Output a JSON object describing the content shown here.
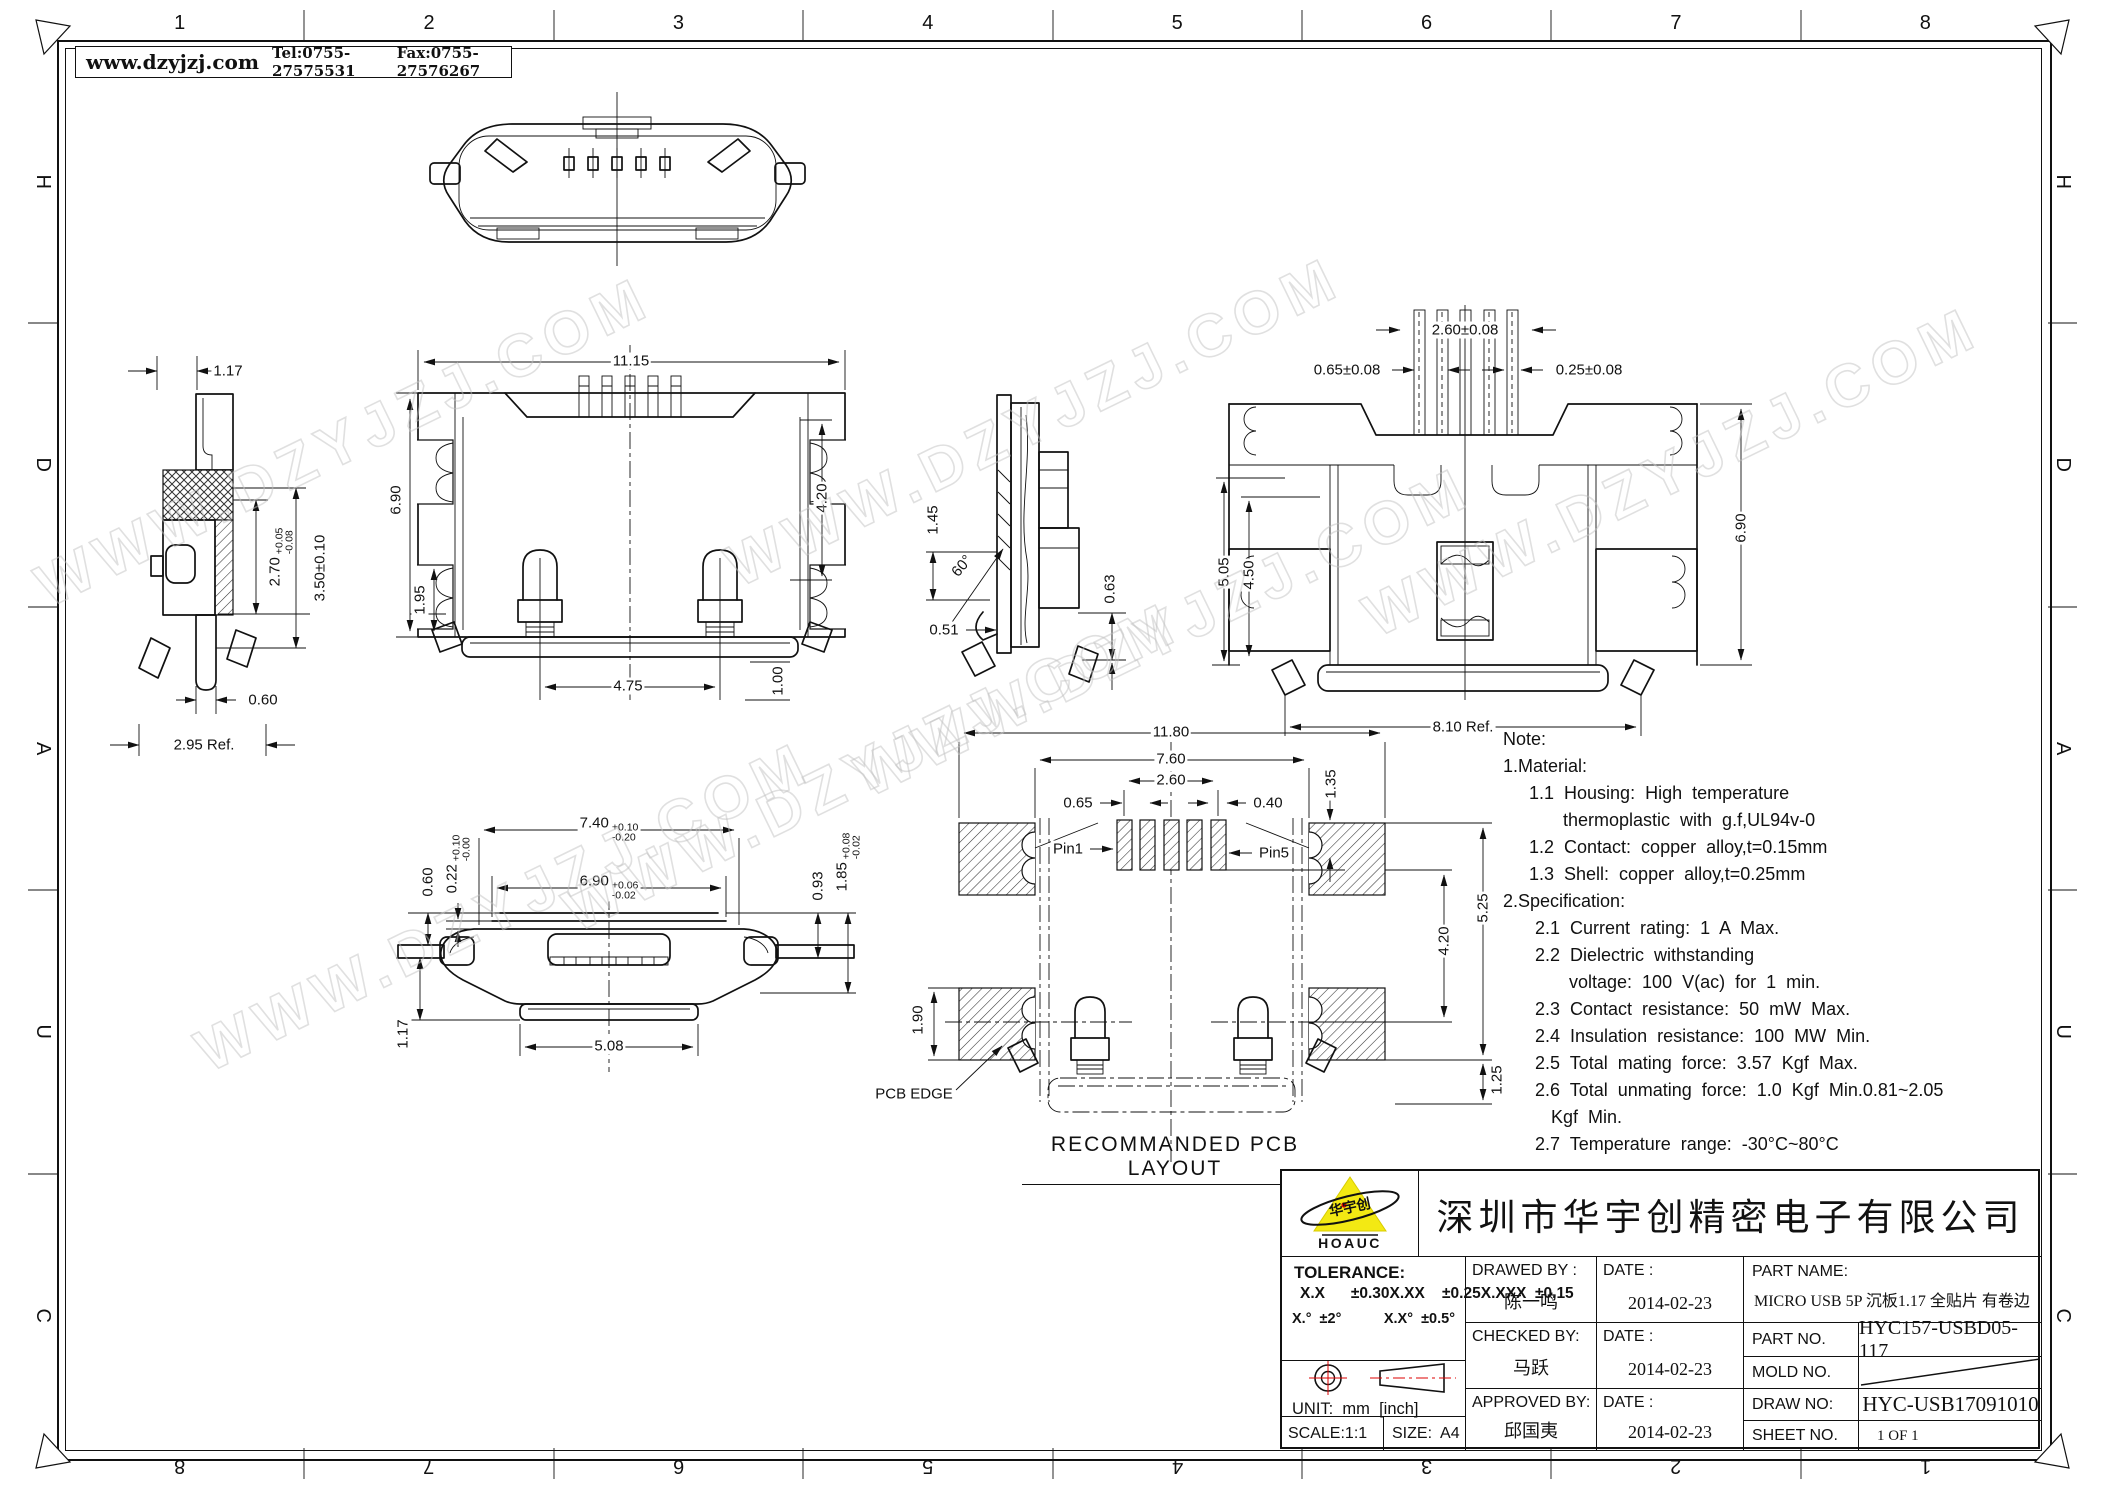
{
  "header": {
    "website": "www.dzyjzj.com",
    "tel": "Tel:0755-27575531",
    "fax": "Fax:0755-27576267"
  },
  "frame": {
    "cols_top": [
      "1",
      "2",
      "3",
      "4",
      "5",
      "6",
      "7",
      "8"
    ],
    "cols_bottom": [
      "8",
      "7",
      "6",
      "5",
      "4",
      "3",
      "2",
      "1"
    ],
    "rows_left": [
      "H",
      "D",
      "A",
      "U",
      "C"
    ],
    "rows_right": [
      "H",
      "D",
      "A",
      "U",
      "C"
    ]
  },
  "watermark": {
    "text": "WWW.DZYJZJ.COM"
  },
  "views": {
    "side": {
      "w": "1.17",
      "h1": "2.70",
      "h1up": "+0.05",
      "h1dn": "-0.08",
      "h2": "3.50±0.10",
      "pin": "0.60",
      "ref": "2.95 Ref."
    },
    "front": {
      "w": "11.15",
      "h": "6.90",
      "h2": "1.95",
      "r": "4.20",
      "b": "4.75",
      "b2": "1.00"
    },
    "section": {
      "a": "1.45",
      "ang": "60°",
      "b": "0.51",
      "c": "0.63"
    },
    "back": {
      "t": "2.60±0.08",
      "tl": "0.65±0.08",
      "tr": "0.25±0.08",
      "l1": "5.05",
      "l2": "4.50",
      "r": "6.90",
      "b": "8.10 Ref."
    },
    "bottom": {
      "d1": "7.40",
      "d1up": "+0.10",
      "d1dn": "-0.20",
      "d2": "6.90",
      "d2up": "+0.06",
      "d2dn": "-0.02",
      "d3": "0.60",
      "d4": "0.22",
      "d4up": "+0.10",
      "d4dn": "-0.00",
      "d5": "0.93",
      "d6": "1.85",
      "d6up": "+0.08",
      "d6dn": "-0.02",
      "d7": "1.17",
      "d8": "5.08"
    },
    "pcb": {
      "d1": "11.80",
      "d2": "7.60",
      "d3": "2.60",
      "d4": "0.65",
      "d5": "0.40",
      "d6": "1.35",
      "pin1": "Pin1",
      "pin5": "Pin5",
      "d7": "4.20",
      "d8": "5.25",
      "d9": "1.90",
      "d10": "1.25",
      "edge": "PCB EDGE",
      "caption": "RECOMMANDED PCB LAYOUT"
    }
  },
  "notes": {
    "lines": [
      "Note:",
      "1.Material:",
      "1.1 Housing: High temperature",
      "thermoplastic with g.f,UL94v-0",
      "1.2 Contact: copper alloy,t=0.15mm",
      "1.3 Shell: copper alloy,t=0.25mm",
      "2.Specification:",
      "2.1 Current rating: 1 A Max.",
      "2.2 Dielectric withstanding",
      "voltage: 100 V(ac) for 1 min.",
      "2.3 Contact resistance: 50 mW Max.",
      "2.4 Insulation resistance: 100 MW Min.",
      "2.5 Total mating force: 3.57 Kgf Max.",
      "2.6 Total unmating force: 1.0 Kgf Min.0.81~2.05",
      "Kgf Min.",
      "2.7 Temperature range: -30°C~80°C"
    ]
  },
  "title_block": {
    "company": "深圳市华宇创精密电子有限公司",
    "logo": {
      "cn": "华宇创",
      "en": "HOAUC"
    },
    "tolerance": {
      "label": "TOLERANCE:",
      "rows": [
        "X.X      ±0.30",
        "X.XX    ±0.25",
        "X.XXX  ±0.15"
      ],
      "angle1": "X.°  ±2°",
      "angle2": "X.X°  ±0.5°"
    },
    "unit": "UNIT:  mm  [inch]",
    "scale": "SCALE:1:1",
    "size": "SIZE:  A4",
    "drawed": {
      "label": "DRAWED BY :",
      "name": "陈一鸣",
      "date_label": "DATE :",
      "date": "2014-02-23"
    },
    "checked": {
      "label": "CHECKED BY:",
      "name": "马跃",
      "date_label": "DATE :",
      "date": "2014-02-23"
    },
    "approved": {
      "label": "APPROVED BY:",
      "name": "邱国夷",
      "date_label": "DATE :",
      "date": "2014-02-23"
    },
    "part_name": {
      "label": "PART NAME:",
      "value": "MICRO USB 5P 沉板1.17 全贴片 有卷边"
    },
    "part_no": {
      "label": "PART NO.",
      "value": "HYC157-USBD05-117"
    },
    "mold_no": {
      "label": "MOLD NO."
    },
    "draw_no": {
      "label": "DRAW NO:",
      "value": "HYC-USB17091010"
    },
    "sheet_no": {
      "label": "SHEET NO.",
      "value": "1 OF 1"
    }
  }
}
